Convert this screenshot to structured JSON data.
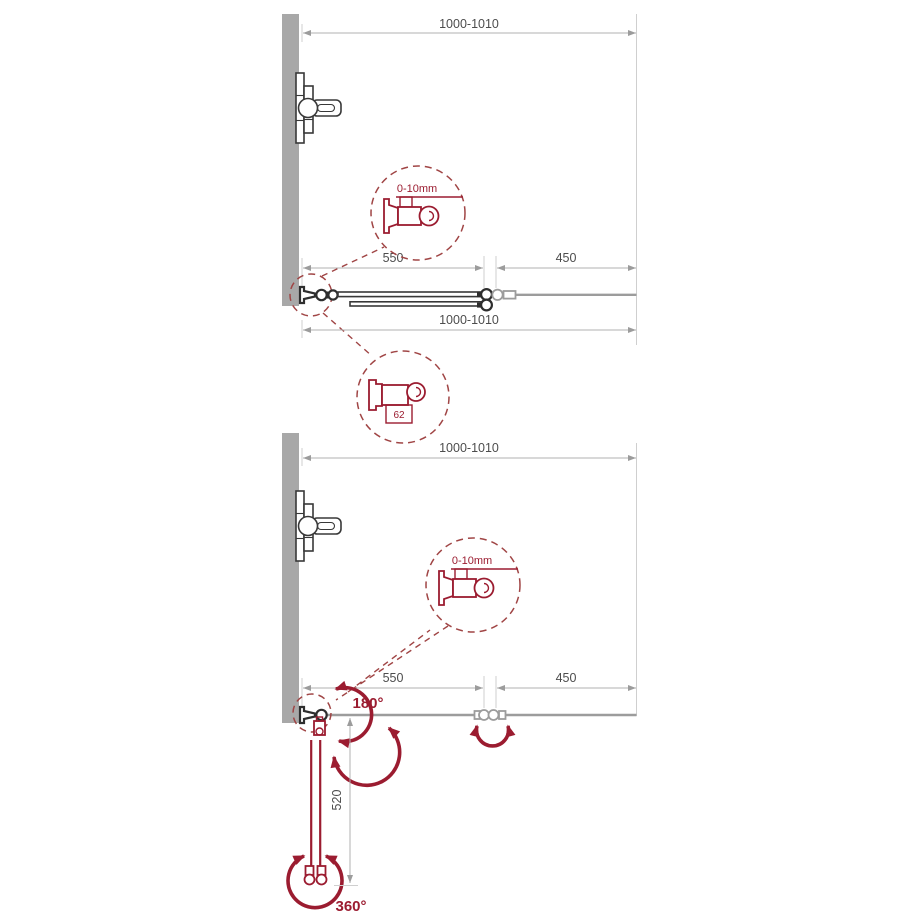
{
  "colors": {
    "accent_red": "#9b1c30",
    "dashed_red": "#a04545",
    "wall_gray": "#a8a8a8",
    "dim_line_gray": "#b0b0b0",
    "panel_gray": "#9c9c9c",
    "drawing_ink": "#383838"
  },
  "details": {
    "gap_label": "0-10mm",
    "hinge_width_label": "62"
  },
  "top_diagram": {
    "dims": {
      "total_top": "1000-1010",
      "panel": "550",
      "fixed": "450",
      "total_bottom": "1000-1010"
    }
  },
  "bottom_diagram": {
    "dims": {
      "total": "1000-1010",
      "panel": "550",
      "fixed": "450",
      "fold_depth": "520"
    },
    "rotations": {
      "wall_hinge": "180°",
      "end_hinge": "360°"
    }
  }
}
